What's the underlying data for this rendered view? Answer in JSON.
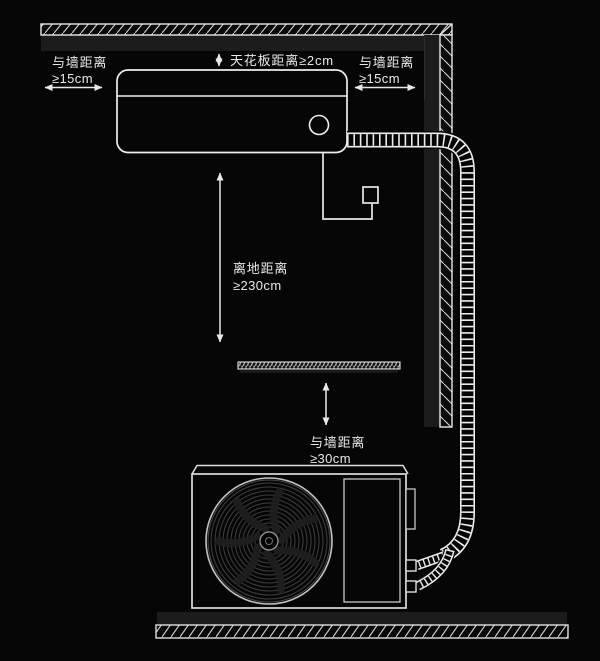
{
  "page": {
    "background": "#060606",
    "kind": "air-conditioner-installation-clearance-diagram"
  },
  "colors": {
    "line": "#e8e8e8",
    "text": "#e9e9e9",
    "shadow_band": "#1c1c1c",
    "fan_ring": "#3c3c3c"
  },
  "annotations": {
    "left_wall_clearance": {
      "line1": "与墙距离",
      "line2": "≥15cm"
    },
    "ceiling_clearance": {
      "text": "天花板距离≥2cm"
    },
    "right_wall_clearance": {
      "line1": "与墙距离",
      "line2": "≥15cm"
    },
    "floor_clearance": {
      "line1": "离地距离",
      "line2": "≥230cm"
    },
    "outdoor_wall_clearance": {
      "line1": "与墙距离",
      "line2": "≥30cm"
    }
  }
}
